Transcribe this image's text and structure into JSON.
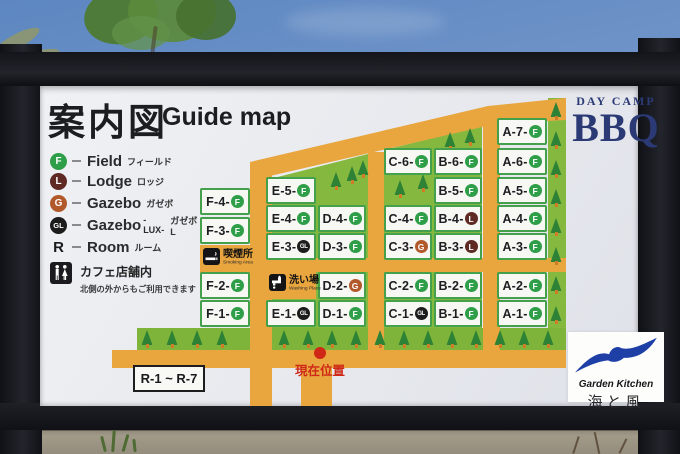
{
  "title": {
    "ja": "案内図",
    "en": "Guide map"
  },
  "brand": {
    "top": "DAY CAMP",
    "main": "BBQ"
  },
  "legend": {
    "items": [
      {
        "badge": "F",
        "label": "Field",
        "kana": "フィールド"
      },
      {
        "badge": "L",
        "label": "Lodge",
        "kana": "ロッジ"
      },
      {
        "badge": "G",
        "label": "Gazebo",
        "kana": "ガゼボ"
      },
      {
        "badge": "GL",
        "label": "Gazebo",
        "lux": "-LUX-",
        "kana": "ガゼボL"
      },
      {
        "badge": "R",
        "label": "Room",
        "kana": "ルーム"
      }
    ],
    "cafe": {
      "title": "カフェ店舗内",
      "note": "北側の外からもご利用できます"
    }
  },
  "facilities": {
    "smoking": {
      "ja": "喫煙所",
      "en": "Smoking Area"
    },
    "washing": {
      "ja": "洗い場",
      "en": "Washing Place"
    }
  },
  "markers": {
    "current_location": "現在位置",
    "room_range": "R-1 ~ R-7"
  },
  "footer": {
    "brand": "Garden Kitchen",
    "name": "海と風"
  },
  "plots": [
    {
      "id": "A-7",
      "badge": "F"
    },
    {
      "id": "A-6",
      "badge": "F"
    },
    {
      "id": "A-5",
      "badge": "F"
    },
    {
      "id": "A-4",
      "badge": "F"
    },
    {
      "id": "A-3",
      "badge": "F"
    },
    {
      "id": "A-2",
      "badge": "F"
    },
    {
      "id": "A-1",
      "badge": "F"
    },
    {
      "id": "B-6",
      "badge": "F"
    },
    {
      "id": "B-5",
      "badge": "F"
    },
    {
      "id": "B-4",
      "badge": "L"
    },
    {
      "id": "B-3",
      "badge": "L"
    },
    {
      "id": "B-2",
      "badge": "F"
    },
    {
      "id": "B-1",
      "badge": "F"
    },
    {
      "id": "C-6",
      "badge": "F"
    },
    {
      "id": "C-4",
      "badge": "F"
    },
    {
      "id": "C-3",
      "badge": "G"
    },
    {
      "id": "C-2",
      "badge": "F"
    },
    {
      "id": "C-1",
      "badge": "GL"
    },
    {
      "id": "D-4",
      "badge": "F"
    },
    {
      "id": "D-3",
      "badge": "F"
    },
    {
      "id": "D-2",
      "badge": "G"
    },
    {
      "id": "D-1",
      "badge": "F"
    },
    {
      "id": "E-5",
      "badge": "F"
    },
    {
      "id": "E-4",
      "badge": "F"
    },
    {
      "id": "E-3",
      "badge": "GL"
    },
    {
      "id": "E-1",
      "badge": "GL"
    },
    {
      "id": "F-4",
      "badge": "F"
    },
    {
      "id": "F-3",
      "badge": "F"
    },
    {
      "id": "F-2",
      "badge": "F"
    },
    {
      "id": "F-1",
      "badge": "F"
    }
  ],
  "colors": {
    "road": "#e9a63e",
    "grass": "#85b83f",
    "grass_bright": "#7fb43a",
    "tree": "#2e8236",
    "trunk": "#cf7c28",
    "badge_f": "#2f9e48",
    "badge_l": "#5e2a23",
    "badge_g": "#b2592b",
    "badge_gl": "#1c1c1c",
    "tile_border": "#44a04a",
    "accent_red": "#cf2817",
    "brand_navy": "#2b3a75",
    "logo_blue": "#1d3fa6"
  }
}
